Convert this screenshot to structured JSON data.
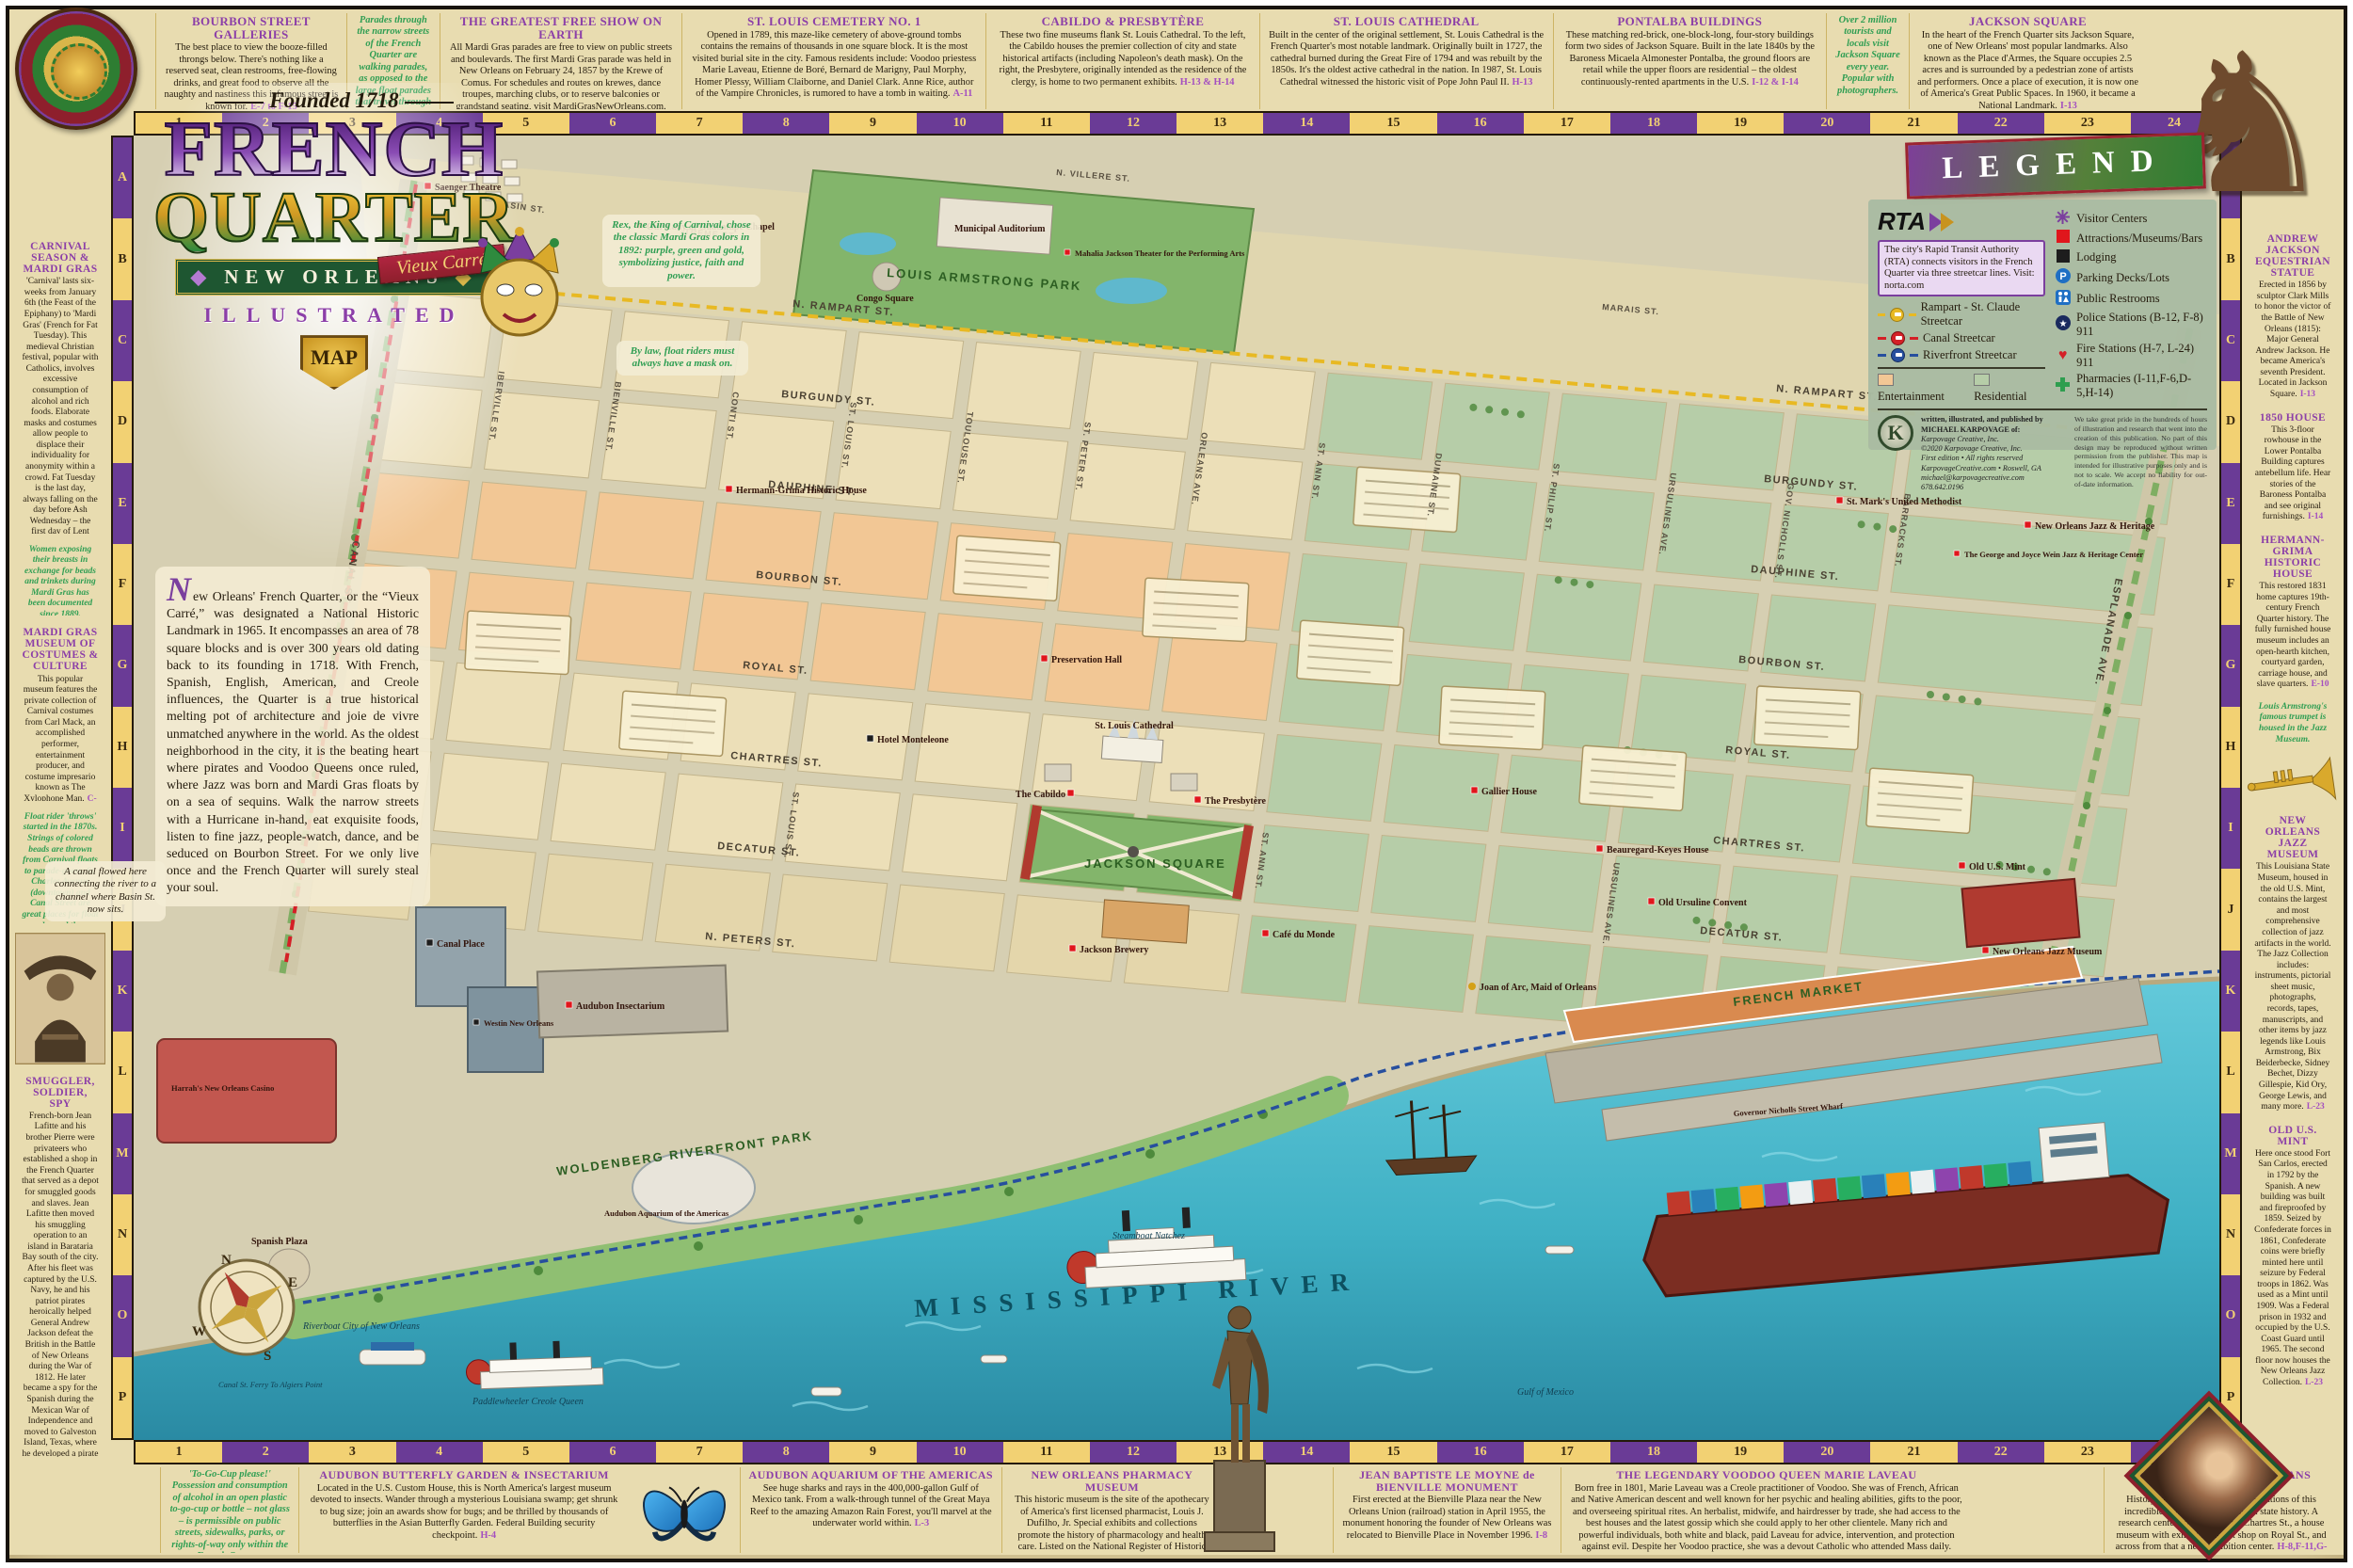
{
  "doc": {
    "founded": "Founded 1718",
    "title1": "FRENCH",
    "title2": "QUARTER",
    "ribbon": "Vieux Carré",
    "city_badge": "NEW ORLEANS",
    "illustrated": "ILLUSTRATED",
    "map_badge": "MAP",
    "intro": "New Orleans' French Quarter, or the “Vieux Carré,” was designated a National Historic Landmark in 1965. It encompasses an area of 78 square blocks and is over 300 years old dating back to its founding in 1718. With French, Spanish, English, American, and Creole influences, the Quarter is a true historical melting pot of architecture and joie de vivre unmatched anywhere in the world. As the oldest neighborhood in the city, it is the beating heart where pirates and Voodoo Queens once ruled, where Jazz was born and Mardi Gras floats by on a sea of sequins. Walk the narrow streets with a Hurricane in-hand, eat exquisite foods, listen to fine jazz, people-watch, dance, and be seduced on Bourbon Street. For we only live once and the French Quarter will surely steal your soul."
  },
  "grid": {
    "columns": [
      "1",
      "2",
      "3",
      "4",
      "5",
      "6",
      "7",
      "8",
      "9",
      "10",
      "11",
      "12",
      "13",
      "14",
      "15",
      "16",
      "17",
      "18",
      "19",
      "20",
      "21",
      "22",
      "23",
      "24"
    ],
    "rows": [
      "A",
      "B",
      "C",
      "D",
      "E",
      "F",
      "G",
      "H",
      "I",
      "J",
      "K",
      "L",
      "M",
      "N",
      "O",
      "P"
    ]
  },
  "borders": {
    "top": [
      {
        "title": "BOURBON STREET GALLERIES",
        "body": "The best place to view the booze-filled throngs below. There's nothing like a reserved seat, clean restrooms, free-flowing drinks, and great food to observe all the naughty and nastiness this infamous street is known for.",
        "ref": "E-7 to F-15"
      },
      {
        "kind": "note",
        "body": "Parades through the narrow streets of the French Quarter are walking parades, as opposed to the large float parades that travel through downtown."
      },
      {
        "title": "THE GREATEST FREE SHOW ON EARTH",
        "body": "All Mardi Gras parades are free to view on public streets and boulevards. The first Mardi Gras parade was held in New Orleans on February 24, 1857 by the Krewe of Comus. For schedules and routes on krewes, dance troupes, marching clubs, or to reserve balconies or grandstand seating, visit MardiGrasNewOrleans.com."
      },
      {
        "title": "ST. LOUIS CEMETERY NO. 1",
        "body": "Opened in 1789, this maze-like cemetery of above-ground tombs contains the remains of thousands in one square block. It is the most visited burial site in the city. Famous residents include: Voodoo priestess Marie Laveau, Etienne de Boré, Bernard de Marigny, Paul Morphy, Homer Plessy, William Claiborne, and Daniel Clark. Anne Rice, author of the Vampire Chronicles, is rumored to have a tomb in waiting.",
        "ref": "A-11"
      },
      {
        "title": "CABILDO & PRESBYTÈRE",
        "body": "These two fine museums flank St. Louis Cathedral. To the left, the Cabildo houses the premier collection of city and state historical artifacts (including Napoleon's death mask). On the right, the Presbytere, originally intended as the residence of the clergy, is home to two permanent exhibits.",
        "ref": "H-13 & H-14"
      },
      {
        "title": "ST. LOUIS CATHEDRAL",
        "body": "Built in the center of the original settlement, St. Louis Cathedral is the French Quarter's most notable landmark. Originally built in 1727, the cathedral burned during the Great Fire of 1794 and was rebuilt by the 1850s. It's the oldest active cathedral in the nation. In 1987, St. Louis Cathedral witnessed the historic visit of Pope John Paul II.",
        "ref": "H-13"
      },
      {
        "title": "PONTALBA BUILDINGS",
        "body": "These matching red-brick, one-block-long, four-story buildings form two sides of Jackson Square. Built in the late 1840s by the Baroness Micaela Almonester Pontalba, the ground floors are retail while the upper floors are residential – the oldest continuously-rented apartments in the U.S.",
        "ref": "I-12 & I-14"
      },
      {
        "kind": "note",
        "body": "Over 2 million tourists and locals visit Jackson Square every year. Popular with photographers."
      },
      {
        "title": "JACKSON SQUARE",
        "body": "In the heart of the French Quarter sits Jackson Square, one of New Orleans' most popular landmarks. Also known as the Place d'Armes, the Square occupies 2.5 acres and is surrounded by a pedestrian zone of artists and performers. Once a place of execution, it is now one of America's Great Public Spaces. In 1960, it became a National Landmark.",
        "ref": "I-13"
      }
    ],
    "left_a": [
      {
        "title": "CARNIVAL SEASON & MARDI GRAS",
        "body": "'Carnival' lasts six-weeks from January 6th (the Feast of the Epiphany) to 'Mardi Gras' (French for Fat Tuesday). This medieval Christian festival, popular with Catholics, involves excessive consumption of alcohol and rich foods. Elaborate masks and costumes allow people to displace their individuality for anonymity within a crowd. Fat Tuesday is the last day, always falling on the day before Ash Wednesday – the first day of Lent involving confession of sins and fasting."
      },
      {
        "kind": "note",
        "body": "Women exposing their breasts in exchange for beads and trinkets during Mardi Gras has been documented since 1889."
      },
      {
        "title": "MARDI GRAS MUSEUM OF COSTUMES & CULTURE",
        "body": "This popular museum features the private collection of Carnival costumes from Carl Mack, an accomplished performer, entertainment producer, and costume impresario known as The Xylophone Man.",
        "ref": "C-10"
      },
      {
        "kind": "note",
        "body": "Float rider 'throws' started in the 1870s. Strings of colored beads are thrown from Carnival floats to parade-goers. St. Charles Avenue (downtown) and Canal Street are great places for float parades and throws."
      }
    ],
    "left_b": [
      {
        "title": "SMUGGLER, SOLDIER, SPY",
        "body": "French-born Jean Lafitte and his brother Pierre were privateers who established a shop in the French Quarter that served as a depot for smuggled goods and slaves. Jean Lafitte then moved his smuggling operation to an island in Barataria Bay south of the city. After his fleet was captured by the U.S. Navy, he and his patriot pirates heroically helped General Andrew Jackson defeat the British in the Battle of New Orleans during the War of 1812. He later became a spy for the Spanish during the Mexican War of Independence and moved to Galveston Island, Texas, where he developed a pirate colony called Campeche. Died in battle in 1823.",
        "ref": "H-8"
      }
    ],
    "right_a": [
      {
        "title": "ANDREW JACKSON EQUESTRIAN STATUE",
        "body": "Erected in 1856 by sculptor Clark Mills to honor the victor of the Battle of New Orleans (1815): Major General Andrew Jackson. He became America's seventh President. Located in Jackson Square.",
        "ref": "I-13"
      },
      {
        "title": "1850 HOUSE",
        "body": "This 3-floor rowhouse in the Lower Pontalba Building captures antebellum life. Hear stories of the Baroness Pontalba and see original furnishings.",
        "ref": "I-14"
      },
      {
        "title": "HERMANN-GRIMA HISTORIC HOUSE",
        "body": "This restored 1831 home captures 19th-century French Quarter history. The fully furnished house museum includes an open-hearth kitchen, courtyard garden, carriage house, and slave quarters.",
        "ref": "E-10"
      },
      {
        "kind": "note",
        "body": "Louis Armstrong's famous trumpet is housed in the Jazz Museum."
      }
    ],
    "right_b": [
      {
        "title": "NEW ORLEANS JAZZ MUSEUM",
        "body": "This Louisiana State Museum, housed in the old U.S. Mint, contains the largest and most comprehensive collection of jazz artifacts in the world. The Jazz Collection includes: instruments, pictorial sheet music, photographs, records, tapes, manuscripts, and other items by jazz legends like Louis Armstrong, Bix Beiderbecke, Sidney Bechet, Dizzy Gillespie, Kid Ory, George Lewis, and many more.",
        "ref": "L-23"
      },
      {
        "title": "OLD U.S. MINT",
        "body": "Here once stood Fort San Carlos, erected in 1792 by the Spanish. A new building was built and fireproofed by 1859. Seized by Confederate forces in 1861, Confederate coins were briefly minted here until seizure by Federal troops in 1862. Was used as a Mint until 1909. Was a Federal prison in 1932 and occupied by the U.S. Coast Guard until 1965. The second floor now houses the New Orleans Jazz Collection.",
        "ref": "L-23"
      }
    ],
    "bottom_a": [
      {
        "kind": "note",
        "body": "'To-Go-Cup please!' Possession and consumption of alcohol in an open plastic to-go-cup or bottle – not glass – is permissible on public streets, sidewalks, parks, or rights-of-way only within the French Quarter."
      },
      {
        "title": "AUDUBON BUTTERFLY GARDEN & INSECTARIUM",
        "body": "Located in the U.S. Custom House, this is North America's largest museum devoted to insects. Wander through a mysterious Louisiana swamp; get shrunk to bug size; join an awards show for bugs; and be thrilled by thousands of butterflies in the Asian Butterfly Garden. Federal Building security checkpoint.",
        "ref": "H-4"
      }
    ],
    "bottom_b": [
      {
        "title": "AUDUBON AQUARIUM OF THE AMERICAS",
        "body": "See huge sharks and rays in the 400,000-gallon Gulf of Mexico tank. From a walk-through tunnel of the Great Maya Reef to the amazing Amazon Rain Forest, you'll marvel at the underwater world within.",
        "ref": "L-3"
      },
      {
        "title": "NEW ORLEANS PHARMACY MUSEUM",
        "body": "This historic museum is the site of the apothecary of America's first licensed pharmacist, Louis J. Dufilho, Jr. Special exhibits and collections promote the history of pharmacology and health care. Listed on the National Register of Historic Places.",
        "ref": "H-10"
      }
    ],
    "bottom_c": [
      {
        "title": "JEAN BAPTISTE LE MOYNE de BIENVILLE MONUMENT",
        "body": "First erected at the Bienville Plaza near the New Orleans Union (railroad) station in April 1955, the monument honoring the founder of New Orleans was relocated to Bienville Place in November 1996.",
        "ref": "I-8"
      },
      {
        "title": "THE LEGENDARY VOODOO QUEEN MARIE LAVEAU",
        "body": "Born free in 1801, Marie Laveau was a Creole practitioner of Voodoo. She was of French, African and Native American descent and well known for her psychic and healing abilities, gifts to the poor, and overseeing spiritual rites. An herbalist, midwife, and hairdresser by trade, she had access to the best houses and the latest gossip which she could apply to her other clientele. Many rich and powerful individuals, both white and black, paid Laveau for advice, intervention, and protection against evil. Despite her Voodoo practice, she was a devout Catholic who attended Mass daily. Today, visitors to her 'Widow Paris' tomb in St. Louis Cemetery No. 1 bring her candles and beads and still ask her for favors.",
        "ref": "A-11"
      }
    ],
    "bottom_d": [
      {
        "title": "THE HISTORIC NEW ORLEANS COLLECTION",
        "body": "History buffs will love the three locations of this incredible collection on Louisiana state history. A research center and archives on Chartres St., a house museum with exhibits and gift shop on Royal St., and across from that a new exhibition center.",
        "ref": "H-8,F-11,G-10"
      }
    ]
  },
  "legend": {
    "title": "LEGEND",
    "rta": "RTA",
    "rta_text": "The city's Rapid Transit Authority (RTA) connects visitors in the French Quarter via three streetcar lines. Visit: norta.com",
    "lines": [
      "Rampart - St. Claude Streetcar",
      "Canal Streetcar",
      "Riverfront Streetcar"
    ],
    "symbols": [
      "Visitor Centers",
      "Attractions/Museums/Bars",
      "Lodging",
      "Parking Decks/Lots",
      "Public Restrooms",
      "Police Stations (B-12, F-8) 911",
      "Fire Stations (H-7, L-24) 911",
      "Pharmacies (I-11,F-6,D-5,H-14)"
    ],
    "swatches": [
      "Entertainment",
      "Residential"
    ],
    "swatch_colors": [
      "#f2c795",
      "#b6cda8"
    ],
    "credit": [
      "written, illustrated, and published by",
      "MICHAEL KARPOVAGE of:",
      "Karpovage Creative, Inc.",
      "©2020 Karpovage Creative, Inc.",
      "First edition • All rights reserved",
      "KarpovageCreative.com • Roswell, GA",
      "michael@karpovagecreative.com",
      "678.642.0196"
    ],
    "disclaimer": "We take great pride in the hundreds of hours of illustration and research that went into the creation of this publication. No part of this design may be reproduced without written permission from the publisher. This map is intended for illustrative purposes only and is not to scale. We accept no liability for out-of-date information."
  },
  "map": {
    "streets": {
      "long": [
        "N. RAMPART ST.",
        "BURGUNDY ST.",
        "DAUPHINE ST.",
        "BOURBON ST.",
        "ROYAL ST.",
        "CHARTRES ST.",
        "DECATUR ST.",
        "N. PETERS ST."
      ],
      "cross": [
        "IBERVILLE ST.",
        "BIENVILLE ST.",
        "CONTI ST.",
        "ST. LOUIS ST.",
        "TOULOUSE ST.",
        "ST. PETER ST.",
        "ORLEANS AVE.",
        "ST. ANN ST.",
        "DUMAINE ST.",
        "ST. PHILIP ST.",
        "URSULINES AVE.",
        "GOV. NICHOLLS ST.",
        "BARRACKS ST."
      ],
      "edges": [
        "CANAL ST.",
        "ESPLANADE AVE."
      ],
      "upper": [
        "BASIN ST.",
        "TREME ST.",
        "N. VILLERE ST.",
        "MARAIS ST."
      ]
    },
    "areas": [
      "LOUIS ARMSTRONG PARK",
      "WOLDENBERG RIVERFRONT PARK",
      "FRENCH MARKET",
      "JACKSON SQUARE"
    ],
    "river_label": "MISSISSIPPI RIVER",
    "compass": [
      "N",
      "E",
      "S",
      "W"
    ],
    "notes": {
      "rex": "Rex, the King of Carnival, chose the classic Mardi Gras colors in 1892: purple, green and gold, symbolizing justice, faith and power.",
      "mask": "By law, float riders must always have a mask on.",
      "canal": "A canal flowed here connecting the river to a channel where Basin St. now sits."
    },
    "pois": [
      "Saenger Theatre",
      "Our Lady of Guadalupe Chapel",
      "Municipal Auditorium",
      "Mahalia Jackson Theater for the Performing Arts",
      "Congo Square",
      "Hermann-Grima Historic House",
      "Preservation Hall",
      "Hotel Monteleone",
      "St. Louis Cathedral",
      "The Cabildo",
      "The Presbytère",
      "Café du Monde",
      "Jackson Brewery",
      "Steamboat Natchez",
      "Beauregard-Keyes House",
      "Gallier House",
      "Old Ursuline Convent",
      "Old U.S. Mint",
      "New Orleans Jazz Museum",
      "St. Mark's United Methodist",
      "New Orleans Jazz & Heritage",
      "The George and Joyce Wein Jazz & Heritage Center",
      "Audubon Insectarium",
      "Audubon Aquarium of the Americas",
      "Harrah's New Orleans Casino",
      "Canal Place",
      "Westin New Orleans",
      "Spanish Plaza",
      "Paddlewheeler Creole Queen",
      "Riverboat City of New Orleans",
      "Canal St. Ferry To Algiers Point",
      "Joan of Arc, Maid of Orleans",
      "Governor Nicholls Street Wharf",
      "Gulf of Mexico"
    ]
  }
}
